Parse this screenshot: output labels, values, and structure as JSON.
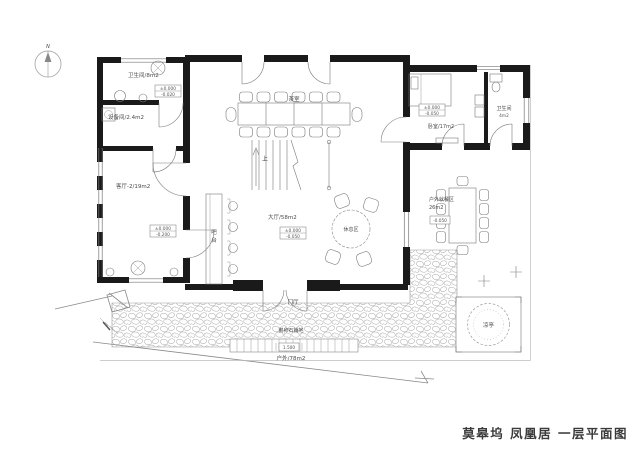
{
  "title": "莫皋坞 凤凰居 一层平面图",
  "compass": {
    "north": "N"
  },
  "rooms": {
    "bathroom_left": "卫生间/8m2",
    "equipment": "设备间/2.4m2",
    "living_2": "客厅-2/19m2",
    "tea_room": "茶室",
    "hall": "大厅/58m2",
    "lounge": "休息区",
    "bedroom": "卧室/17m2",
    "bathroom_right": "卫生间",
    "bathroom_right_area": "4m2",
    "outdoor_dining": "户外就餐区",
    "outdoor_dining_area": "26m2",
    "entry": "门厅",
    "outdoor": "户外/78m2",
    "pavilion": "凉亭"
  },
  "annotations": {
    "stairs_up": "上",
    "bar_char_1": "吧",
    "bar_char_2": "台",
    "stone_paving": "鹅卵石铺地",
    "dim_entry": "1.500"
  },
  "elevations": {
    "zero": "±0.000",
    "minus_020": "-0.020",
    "minus_050": "-0.050",
    "minus_200": "-0.200"
  },
  "colors": {
    "wall": "#1a1a1a",
    "furniture_line": "#7a7a7a",
    "light_line": "#9a9a9a",
    "label_text": "#4a4a4a",
    "title_text": "#3a3a3a",
    "background": "#ffffff"
  }
}
